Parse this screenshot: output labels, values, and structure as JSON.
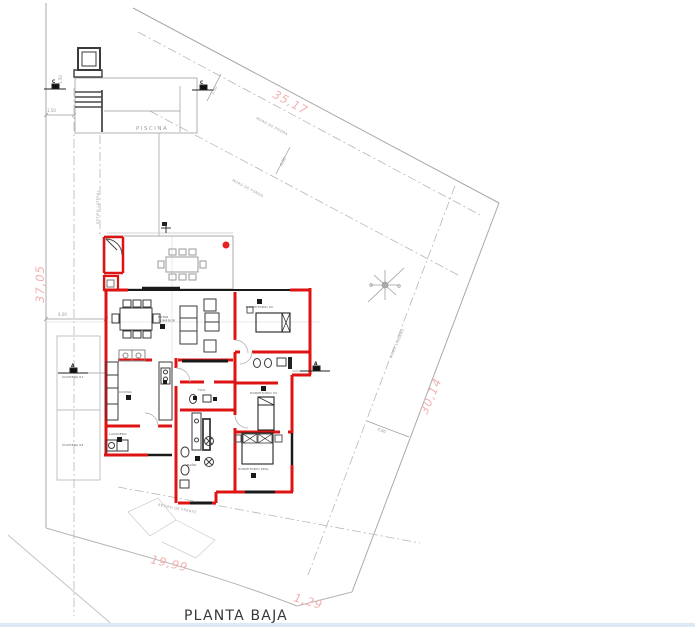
{
  "drawing": {
    "title": "PLANTA BAJA",
    "boundary": {
      "dim_top": "35,17",
      "dim_left": "37,05",
      "dim_right": "30,14",
      "dim_bottom": "19,99",
      "dim_bottom_corner": "1,29"
    },
    "setbacks": {
      "dim_stone_wall": "1,50",
      "dim_side": "1,50",
      "dim_rear": "6,00",
      "dim_front_left": "4,00",
      "dim_right": "4,00",
      "note_stone_wall": "MURO DE PIEDRA",
      "note_rear_wall": "MURO DE FONDO",
      "note_party_wall": "MURO LINDERO",
      "note_front": "RETIRO DE FRENTE",
      "note_lateral": "RETIRO LATERAL"
    },
    "pool_label": "PISCINA",
    "rooms": {
      "living_1": "ESTAR",
      "living_2": "COMEDOR",
      "kitchen": "COCINA",
      "laundry": "LAVADERO",
      "toilet": "TOIL",
      "bath": "BAÑO",
      "bedroom2": "DORMITORIO 02",
      "bedroom3": "DORMITORIO 03",
      "master": "DORMITORIO PPAL",
      "garage1": "COCHERA 01",
      "garage2": "COCHERA 02"
    },
    "sections": {
      "c": "C",
      "a": "A"
    },
    "colors": {
      "wall": "#de1414",
      "dims": "#f2b0b0",
      "lines": "#a9a9a9",
      "title": "#383838"
    }
  }
}
